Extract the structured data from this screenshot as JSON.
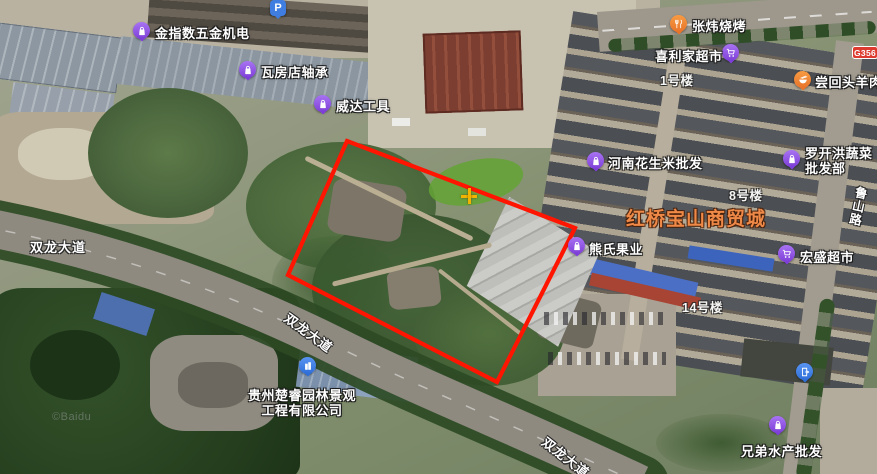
{
  "map": {
    "watermark": "©Baidu",
    "polygon_points": "347,141 575,228 497,382 288,275",
    "polygon_color": "#ff1500",
    "crosshair_color": "#f0b400",
    "badge": {
      "label": "G356"
    }
  },
  "poi": {
    "parking": {
      "label": "P"
    },
    "jinzhishu": {
      "name": "金指数五金机电"
    },
    "wafangdian": {
      "name": "瓦房店轴承"
    },
    "weida": {
      "name": "威达工具"
    },
    "zhangwei": {
      "name": "张炜烧烤"
    },
    "xilijia": {
      "name": "喜利家超市"
    },
    "changhuitou": {
      "name": "尝回头羊肉"
    },
    "henan": {
      "name": "河南花生米批发"
    },
    "luokaihong": {
      "line1": "罗开洪蔬菜",
      "line2": "批发部"
    },
    "xiongshi": {
      "name": "熊氏果业"
    },
    "hongsheng": {
      "name": "宏盛超市"
    },
    "xiongdi": {
      "name": "兄弟水产批发"
    },
    "company": {
      "line1": "贵州楚睿园林景观",
      "line2": "工程有限公司"
    }
  },
  "buildings": {
    "b1": "1号楼",
    "b8": "8号楼",
    "b14": "14号楼"
  },
  "area": {
    "market_name": "红桥宝山商贸城"
  },
  "roads": {
    "shuanglong_left": "双龙大道",
    "shuanglong_mid": "双龙大道",
    "shuanglong_bottom": "双龙大道",
    "lushan": "鲁山路"
  }
}
